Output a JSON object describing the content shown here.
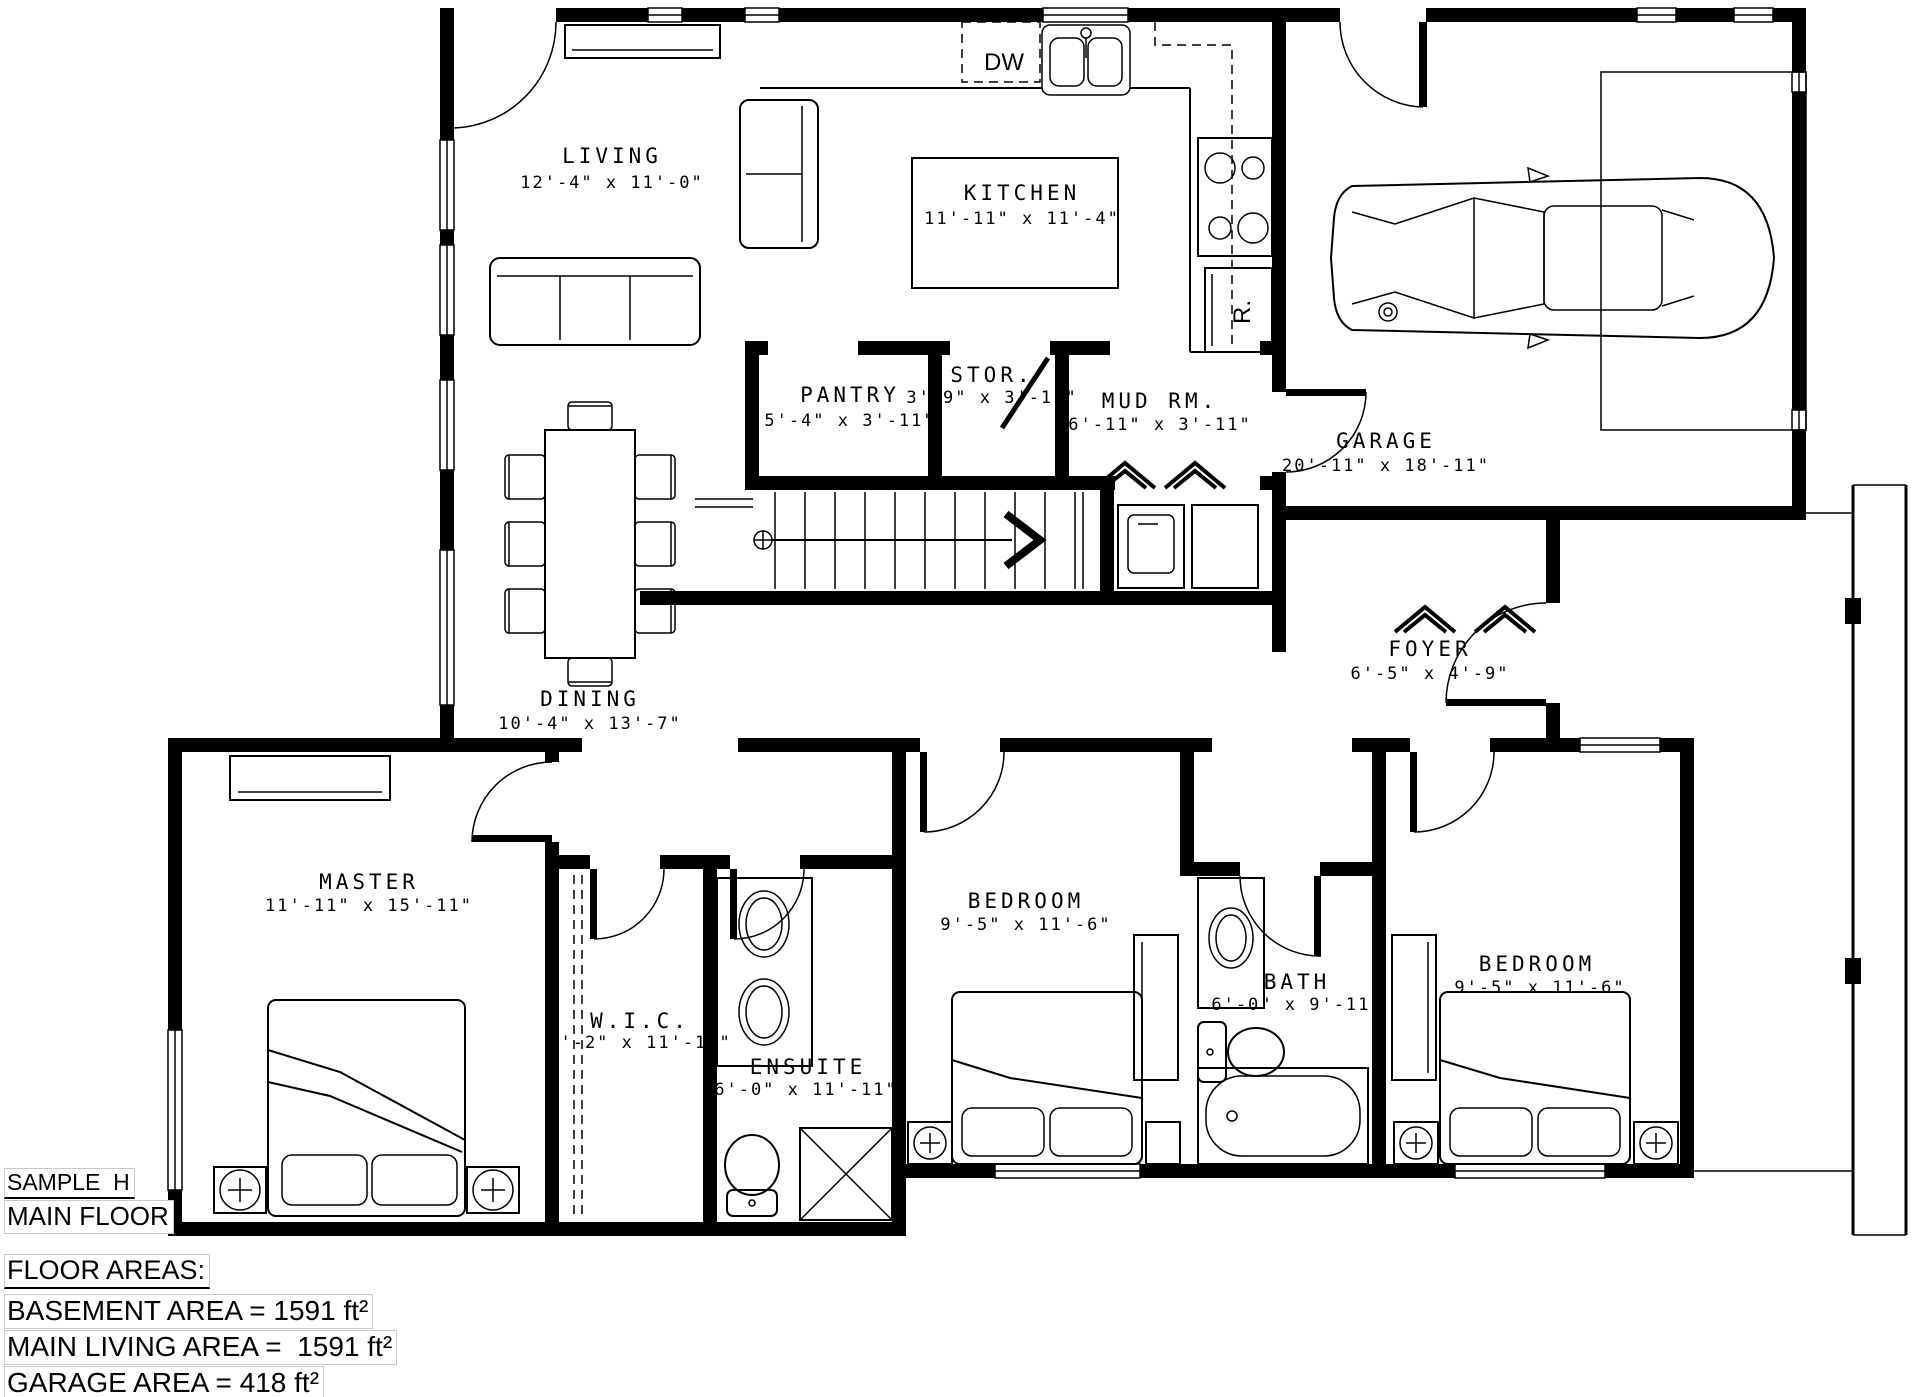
{
  "title_block": {
    "project": "SAMPLE  H",
    "floor": "MAIN FLOOR"
  },
  "floor_areas": {
    "heading": "FLOOR AREAS:",
    "basement": "BASEMENT AREA = 1591 ft²",
    "main_living": "MAIN LIVING AREA =  1591 ft²",
    "garage": "GARAGE AREA = 418 ft²"
  },
  "rooms": {
    "living": {
      "name": "LIVING",
      "dims": "12'-4\" x 11'-0\""
    },
    "kitchen": {
      "name": "KITCHEN",
      "dims": "11'-11\" x 11'-4\""
    },
    "pantry": {
      "name": "PANTRY",
      "dims": "5'-4\" x 3'-11\""
    },
    "storage": {
      "name": "STOR.",
      "dims": "3'-9\" x 3'-11\""
    },
    "mud_room": {
      "name": "MUD RM.",
      "dims": "6'-11\" x 3'-11\""
    },
    "garage": {
      "name": "GARAGE",
      "dims": "20'-11\" x 18'-11\""
    },
    "dining": {
      "name": "DINING",
      "dims": "10'-4\" x 13'-7\""
    },
    "foyer": {
      "name": "FOYER",
      "dims": "6'-5\" x 4'-9\""
    },
    "master": {
      "name": "MASTER",
      "dims": "11'-11\" x 15'-11\""
    },
    "wic": {
      "name": "W.I.C.",
      "dims": "5'-2\" x 11'-11\""
    },
    "ensuite": {
      "name": "ENSUITE",
      "dims": "6'-0\" x 11'-11\""
    },
    "bedroom_2": {
      "name": "BEDROOM",
      "dims": "9'-5\" x 11'-6\""
    },
    "bath": {
      "name": "BATH",
      "dims": "6'-0\" x 9'-11\""
    },
    "bedroom_3": {
      "name": "BEDROOM",
      "dims": "9'-5\" x 11'-6\""
    }
  },
  "appliances": {
    "dishwasher": "DW",
    "range": "R."
  },
  "colors": {
    "wall": "#000000",
    "line": "#000000",
    "background": "#ffffff",
    "annotation_box": "#c9c9c9"
  }
}
